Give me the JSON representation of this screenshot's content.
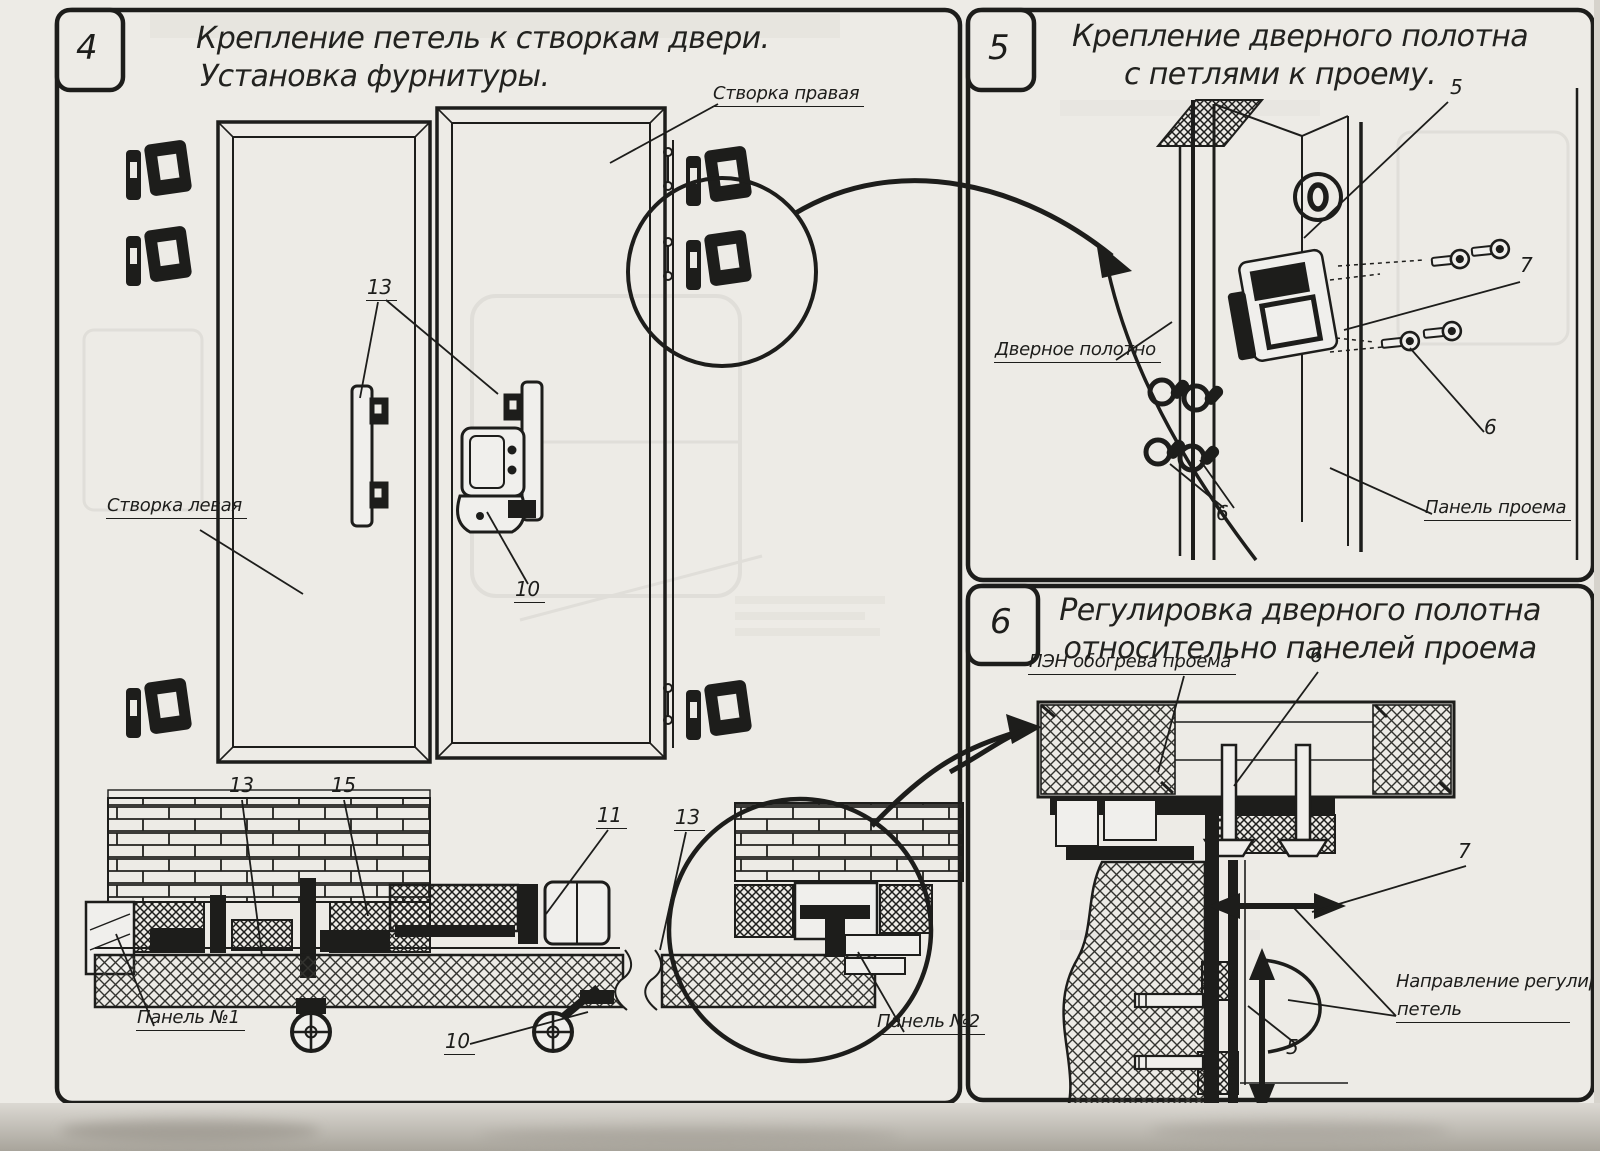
{
  "colors": {
    "paper": "#edebe6",
    "ink": "#1d1d1b"
  },
  "panel4": {
    "number": "4",
    "title_line1": "Крепление петель к створкам двери.",
    "title_line2": "Установка фурнитуры.",
    "labels": {
      "leaf_right": "Створка правая",
      "leaf_left": "Створка левая",
      "callout_13_plates": "13",
      "callout_10_latch": "10",
      "callout_13_section_left": "13",
      "callout_15_section": "15",
      "callout_11_section": "11",
      "callout_13_section_right": "13",
      "callout_10_section": "10",
      "panel_no1": "Панель №1",
      "panel_no2": "Панель №2"
    }
  },
  "panel5": {
    "number": "5",
    "title_line1": "Крепление дверного полотна",
    "title_line2": "с петлями к проему.",
    "labels": {
      "door_leaf": "Дверное полотно",
      "opening_panel": "Панель проема",
      "callout_5": "5",
      "callout_7": "7",
      "callout_6_screws": "6",
      "callout_6_washers": "6"
    }
  },
  "panel6": {
    "number": "6",
    "title_line1": "Регулировка дверного полотна",
    "title_line2": "относительно панелей проема",
    "labels": {
      "pen_heater": "ПЭН обогрева проема",
      "callout_6": "6",
      "callout_7": "7",
      "callout_5": "5",
      "adjust_dir_line1": "Направление регулировки",
      "adjust_dir_line2": "петель"
    }
  }
}
